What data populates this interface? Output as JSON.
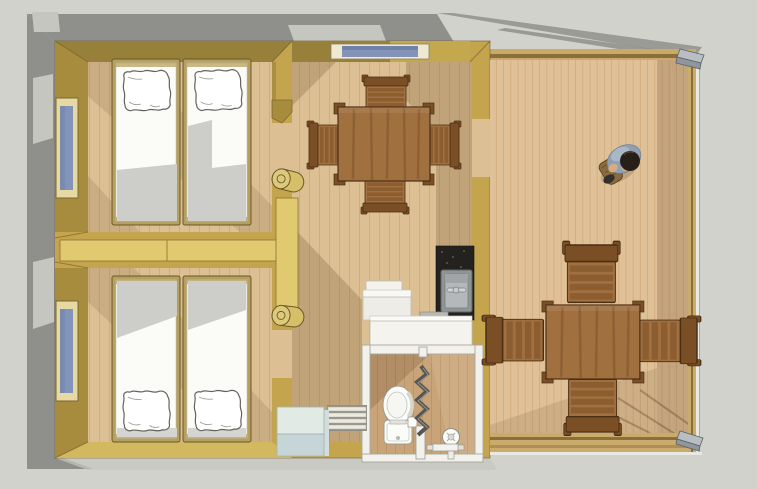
{
  "scene": {
    "title": "Top-down 3D floor plan render of a small cabin: two twin bedrooms, dining room with kitchenette and bathroom, and a large open deck with outdoor dining set and a standing person",
    "render_style": "architectural top view, SketchUp-like shaded render, no text",
    "canvas": {
      "width": 757,
      "height": 489
    },
    "rooms": [
      {
        "id": "bedroom-top-left",
        "label": "Twin bedroom",
        "contents": [
          "single bed with pillow",
          "single bed with pillow",
          "side window"
        ]
      },
      {
        "id": "bedroom-bottom-left",
        "label": "Twin bedroom",
        "contents": [
          "single bed with pillow",
          "single bed with pillow",
          "side window"
        ]
      },
      {
        "id": "dining-room",
        "label": "Dining room",
        "contents": [
          "square wooden table",
          "4 slatted chairs",
          "window in top wall",
          "2 rolled-up canvas doorways"
        ]
      },
      {
        "id": "kitchenette",
        "label": "Kitchenette corner",
        "contents": [
          "dark stone counter",
          "steel sink with tap",
          "white cabinet",
          "white counter"
        ]
      },
      {
        "id": "bathroom",
        "label": "Bathroom",
        "contents": [
          "toilet",
          "zigzag shower curtain",
          "shower head and mixer",
          "paper holder"
        ]
      },
      {
        "id": "entry",
        "label": "Entry",
        "contents": [
          "pale blue entry step",
          "slatted duckboard mat"
        ]
      },
      {
        "id": "deck",
        "label": "Open deck",
        "contents": [
          "square wooden table",
          "4 slatted chairs",
          "perimeter timber railing",
          "metal corner brackets",
          "standing person with shoulder bag"
        ]
      }
    ],
    "person": {
      "description": "person viewed from directly above, dark hair, blue-grey shirt, brown shoulder bag",
      "location": "upper deck area"
    },
    "colors": {
      "background": "#d2d2cc",
      "shadow": "#8f8f8c",
      "shadow_light": "#c6c6c1",
      "roof_shadow": "#9a9a96",
      "wall": "#c5a44e",
      "wall_dark": "#97803a",
      "wall_mid": "#a78c3e",
      "wall_light": "#d2b960",
      "wall_pale": "#e0c96e",
      "bed_frame": "#b5a060",
      "frame_tan": "#e7d9a4",
      "floor": "#dcbf93",
      "floor_line": "#c2a077",
      "bath_floor": "#c9a478",
      "bath_floor_line": "#b08a5c",
      "deck": "#e0c096",
      "deck_line": "#bf9868",
      "wood": "#a0703f",
      "wood_dark": "#7a4f26",
      "wood_stroke": "#4a2f15",
      "roll": "#d5bf69",
      "white": "#fbfbf8",
      "bath_wall": "#f2f1eb",
      "gray_stroke": "#9a9a95",
      "olive_stroke": "#6b5926",
      "mattress_shadow": "#cdcdc9",
      "glass": "#8494b8",
      "glass_dark": "#6f83a8",
      "tray_top": "#e2eae6",
      "tray_front": "#c6d5d7",
      "tray_stroke": "#a6b5b1",
      "metal": "#b9bec3",
      "metal_dark": "#8f969c",
      "counter": "#24221e",
      "sink": "#b4b8ba",
      "sink_dark": "#8f9496",
      "skin": "#d9ab80",
      "shirt": "#8fa0b4",
      "shirt_light": "#aab8c6",
      "hair": "#272019",
      "bag": "#8a6a3e",
      "shoe": "#332f2b"
    }
  }
}
